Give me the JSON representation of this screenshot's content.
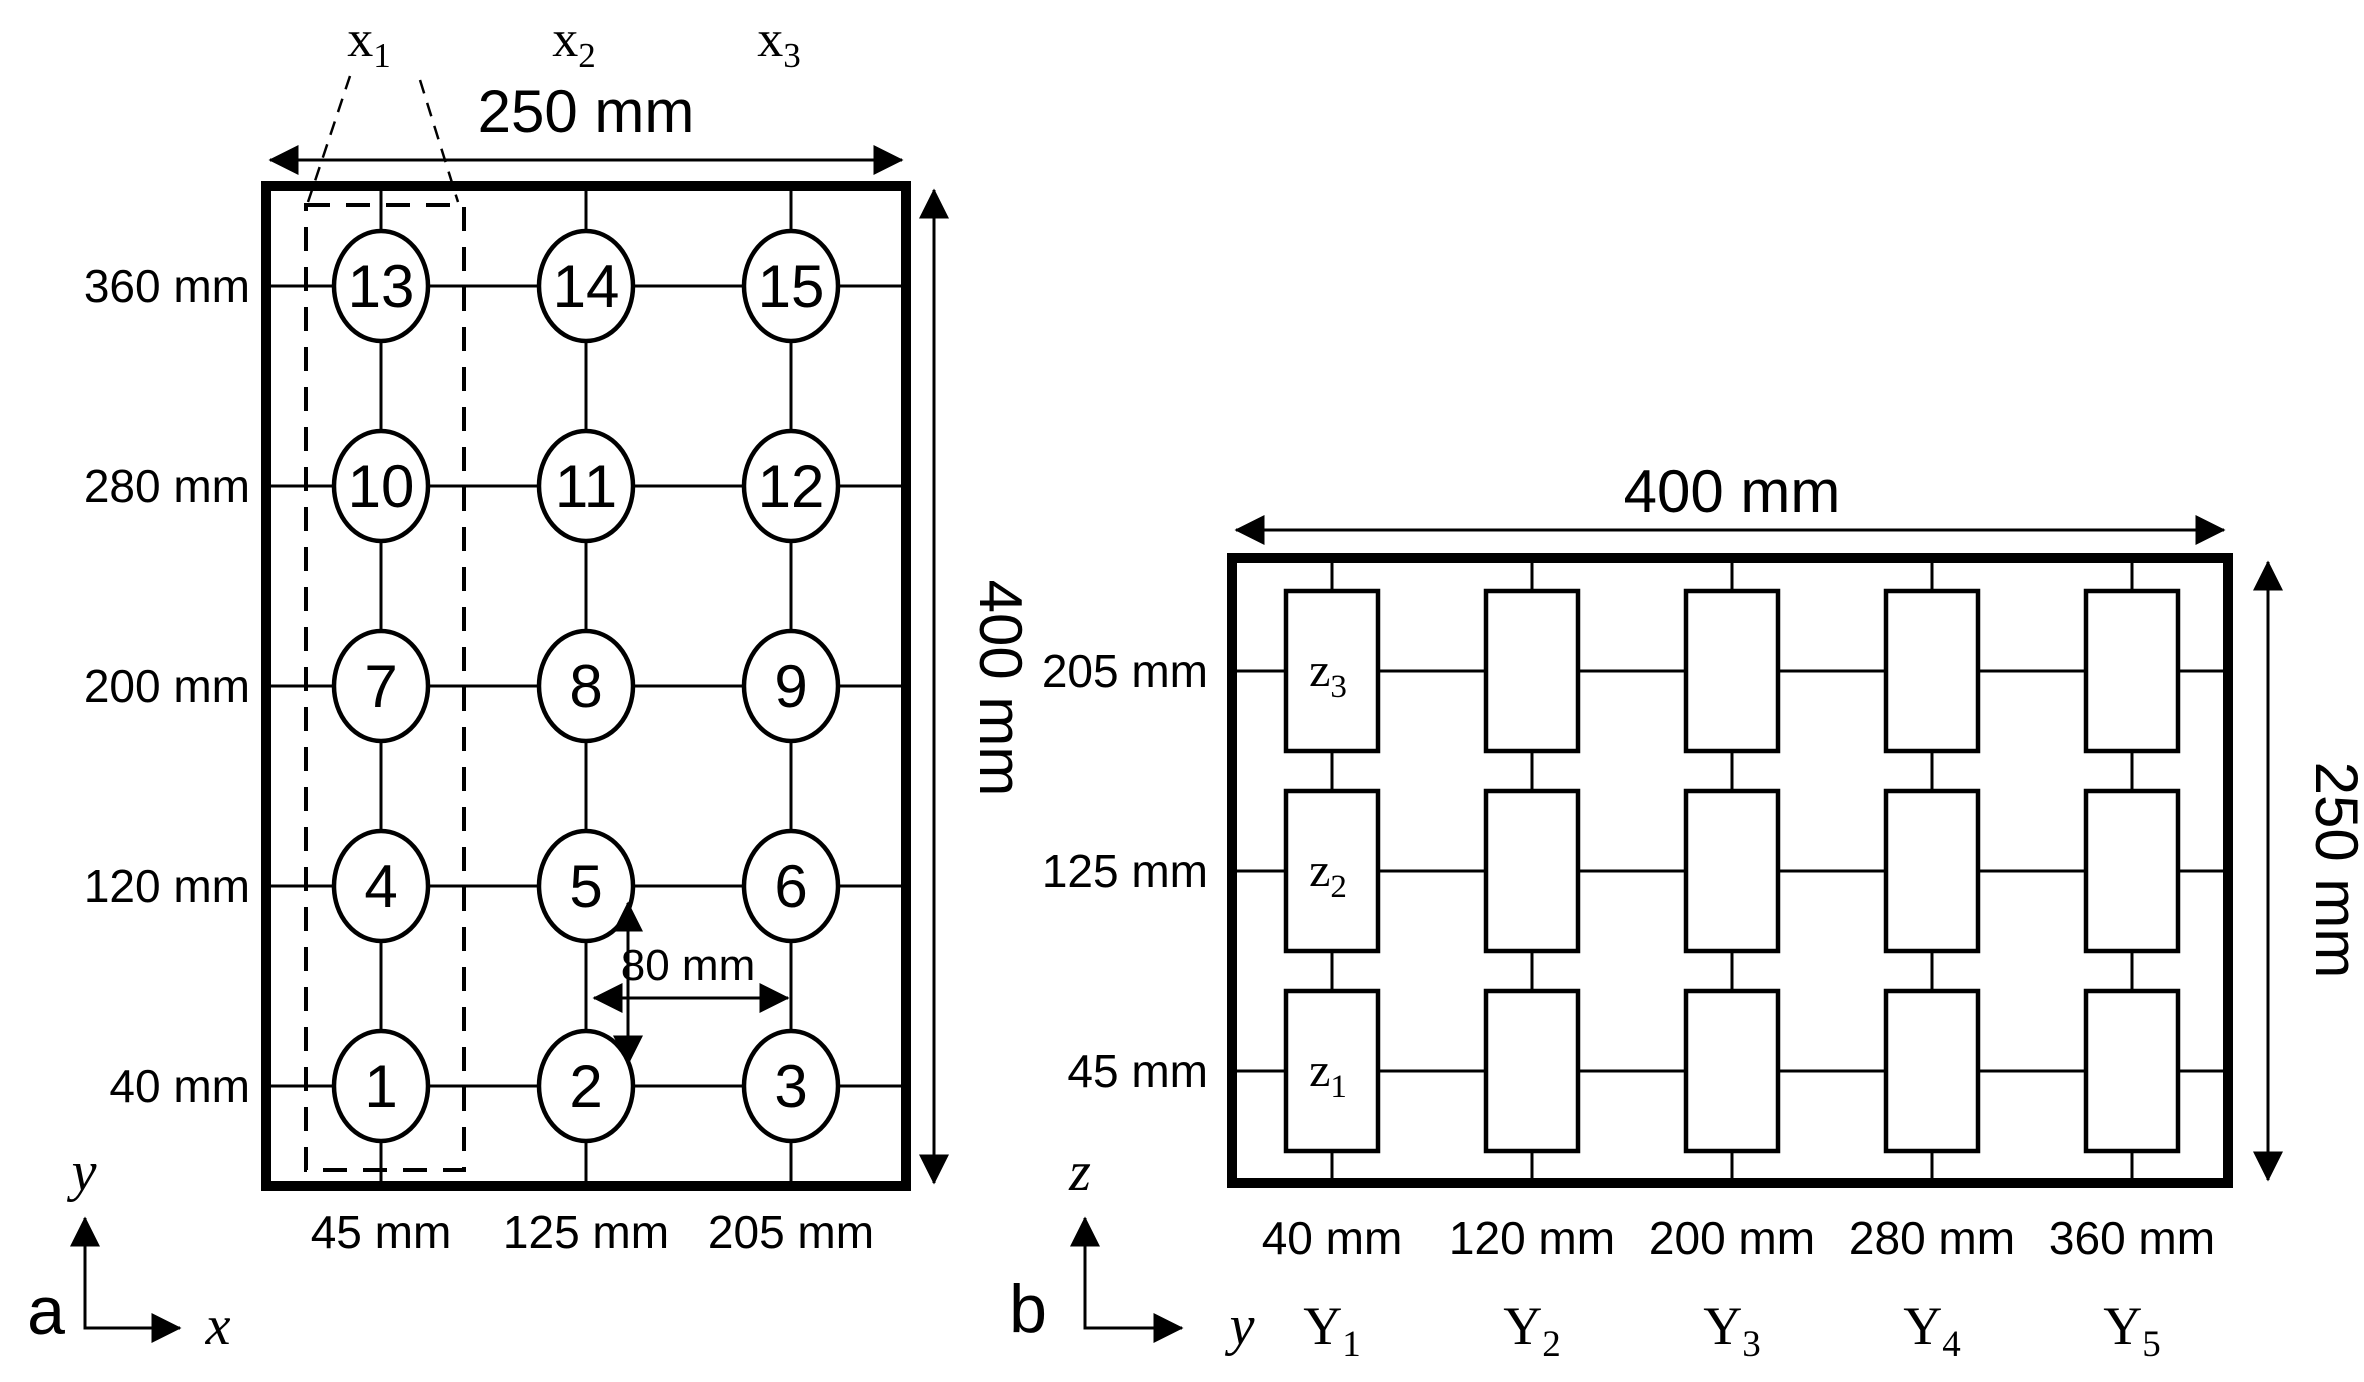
{
  "colors": {
    "ink": "#000000",
    "background": "#ffffff"
  },
  "panel_a": {
    "panel_label": "a",
    "width_dimension": "250 mm",
    "height_dimension": "400 mm",
    "spacing_dimension": "80 mm",
    "vertical_axis_label": "y",
    "horizontal_axis_label": "x",
    "column_headers": [
      {
        "base": "x",
        "sub": "1"
      },
      {
        "base": "x",
        "sub": "2"
      },
      {
        "base": "x",
        "sub": "3"
      }
    ],
    "column_labels": [
      "45 mm",
      "125 mm",
      "205 mm"
    ],
    "rows": [
      {
        "label": "360 mm",
        "points": [
          "13",
          "14",
          "15"
        ]
      },
      {
        "label": "280 mm",
        "points": [
          "10",
          "11",
          "12"
        ]
      },
      {
        "label": "200 mm",
        "points": [
          "7",
          "8",
          "9"
        ]
      },
      {
        "label": "120 mm",
        "points": [
          "4",
          "5",
          "6"
        ]
      },
      {
        "label": "40 mm",
        "points": [
          "1",
          "2",
          "3"
        ]
      }
    ]
  },
  "panel_b": {
    "panel_label": "b",
    "width_dimension": "400 mm",
    "height_dimension": "250 mm",
    "vertical_axis_label": "z",
    "horizontal_axis_label": "y",
    "rows": [
      {
        "label": "205 mm",
        "cell_label": {
          "base": "z",
          "sub": "3"
        }
      },
      {
        "label": "125 mm",
        "cell_label": {
          "base": "z",
          "sub": "2"
        }
      },
      {
        "label": "45 mm",
        "cell_label": {
          "base": "z",
          "sub": "1"
        }
      }
    ],
    "columns": [
      {
        "label": "40 mm",
        "footer": {
          "base": "Y",
          "sub": "1"
        }
      },
      {
        "label": "120 mm",
        "footer": {
          "base": "Y",
          "sub": "2"
        }
      },
      {
        "label": "200 mm",
        "footer": {
          "base": "Y",
          "sub": "3"
        }
      },
      {
        "label": "280 mm",
        "footer": {
          "base": "Y",
          "sub": "4"
        }
      },
      {
        "label": "360 mm",
        "footer": {
          "base": "Y",
          "sub": "5"
        }
      }
    ]
  }
}
